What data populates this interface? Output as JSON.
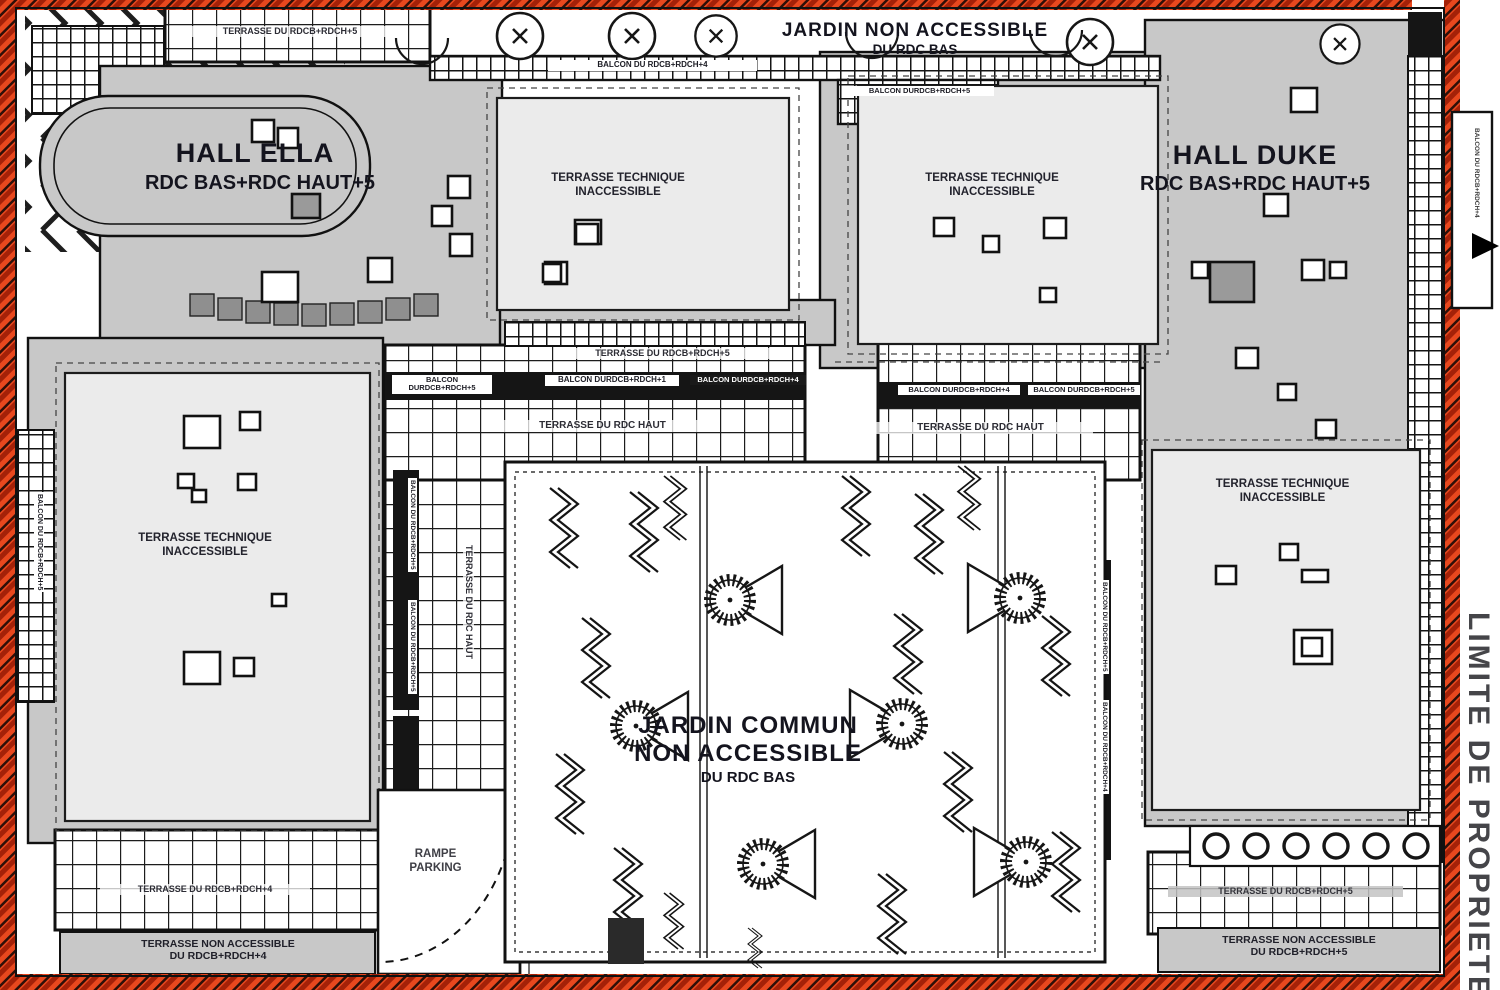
{
  "labels": {
    "hall_ella": {
      "name": "HALL ELLA",
      "levels": "RDC BAS+RDC HAUT+5"
    },
    "hall_duke": {
      "name": "HALL DUKE",
      "levels": "RDC BAS+RDC HAUT+5"
    },
    "jardin_top": {
      "line1": "JARDIN NON ACCESSIBLE",
      "line2": "DU RDC BAS"
    },
    "jardin_central": {
      "line1": "JARDIN COMMUN",
      "line2": "NON ACCESSIBLE",
      "line3": "DU RDC BAS"
    },
    "terrasse_technique": {
      "line1": "TERRASSE TECHNIQUE",
      "line2": "INACCESSIBLE"
    },
    "terrasse_rdc_haut": "TERRASSE DU RDC HAUT",
    "terrasse_rdcb_rdch5": "TERRASSE DU RDCB+RDCH+5",
    "terrasse_rdcb_rdch4": "TERRASSE DU RDCB+RDCH+4",
    "balcon_rdcb_rdch5": {
      "line1": "BALCON DU",
      "line2": "RDCB+RDCH+5"
    },
    "balcon_rdcb_rdch1": {
      "line1": "BALCON DU",
      "line2": "RDCB+RDCH+1"
    },
    "balcon_rdcb_rdch4": {
      "line1": "BALCON DU",
      "line2": "RDCB+RDCH+4"
    },
    "balcon_rdcb_rdch4_inline": "BALCON DU RDCB+RDCH+4",
    "balcon_rdcb_rdch5_inline": "BALCON DU RDCB+RDCH+5",
    "rampe": {
      "line1": "RAMPE",
      "line2": "PARKING"
    },
    "terrasse_non_accessible_4": {
      "line1": "TERRASSE NON ACCESSIBLE",
      "line2": "DU RDCB+RDCH+4"
    },
    "terrasse_non_accessible_5": {
      "line1": "TERRASSE NON ACCESSIBLE",
      "line2": "DU RDCB+RDCH+5"
    },
    "limite_propriete": "LIMITE DE PROPRIETE"
  },
  "colors": {
    "property_line_red": "#e8481e",
    "building_gray": "#c8c8c8",
    "terrace_light": "#ebebeb",
    "line_black": "#161616"
  }
}
